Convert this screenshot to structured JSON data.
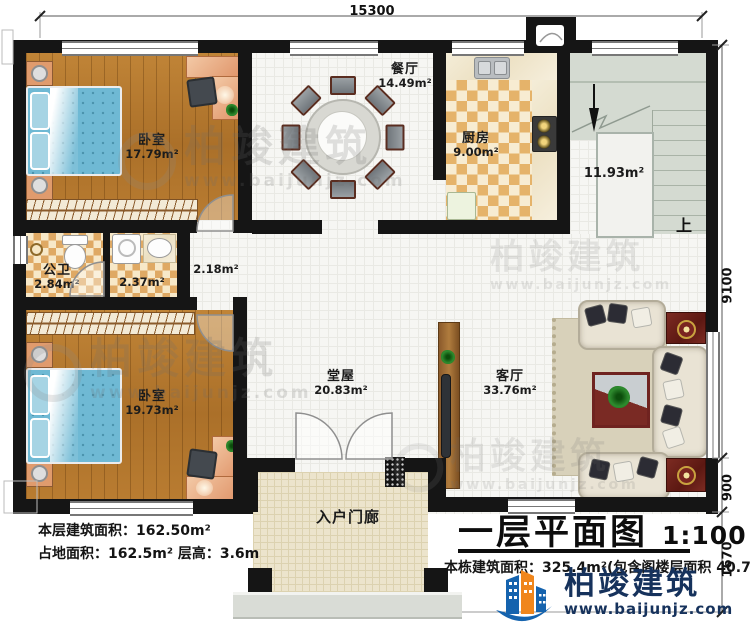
{
  "title_block": {
    "title": "一层平面图",
    "scale": "1:100",
    "note": "本栋建筑面积：325.4m²(包含阁楼层面积 40.7m²)"
  },
  "site_notes": {
    "line1": "本层建筑面积：162.50m²",
    "line2": "占地面积：162.5m²  层高：3.6m"
  },
  "dimensions": {
    "top": "15300",
    "right_main": "9100",
    "right_mid": "900",
    "right_low": "1670"
  },
  "rooms": {
    "bedroom1": {
      "name": "卧室",
      "area": "17.79m²"
    },
    "dining": {
      "name": "餐厅",
      "area": "14.49m²"
    },
    "kitchen": {
      "name": "厨房",
      "area": "9.00m²"
    },
    "stairwell": {
      "area": "11.93m²",
      "direction": "上"
    },
    "bathroom": {
      "name": "公卫",
      "area": "2.84m²"
    },
    "utility": {
      "area": "2.37m²"
    },
    "hallway": {
      "area": "2.18m²"
    },
    "bedroom2": {
      "name": "卧室",
      "area": "19.73m²"
    },
    "hall": {
      "name": "堂屋",
      "area": "20.83m²"
    },
    "living": {
      "name": "客厅",
      "area": "33.76m²"
    },
    "porch": {
      "name": "入户门廊"
    }
  },
  "branding": {
    "brand": "柏竣建筑",
    "url": "www.baijunjz.com"
  },
  "colors": {
    "wall": "#151515",
    "wood": "#b5772e",
    "bed": "#6fb9d4",
    "logo_blue": "#1563ae",
    "logo_orange": "#f0861c"
  }
}
